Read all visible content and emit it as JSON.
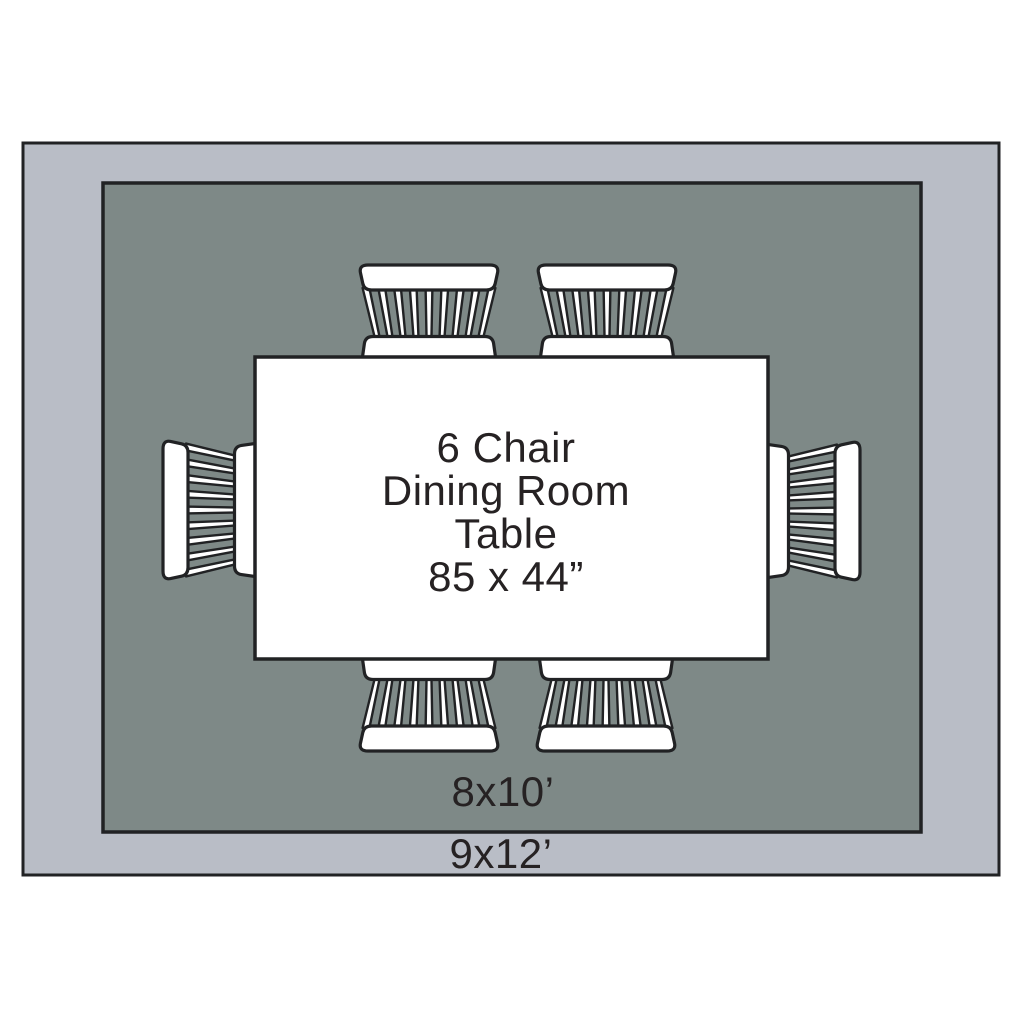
{
  "diagram": {
    "table_label_lines": [
      "6 Chair",
      "Dining Room",
      "Table",
      "85 x 44”"
    ],
    "inner_rug_label": "8x10’",
    "outer_rug_label": "9x12’",
    "chair_count": 6
  },
  "colors": {
    "page_bg": "#ffffff",
    "outer_rug": "#b9bdc6",
    "inner_rug": "#7e8987",
    "outline": "#212224",
    "table_fill": "#ffffff",
    "chair_fill": "#ffffff",
    "text": "#262223"
  }
}
